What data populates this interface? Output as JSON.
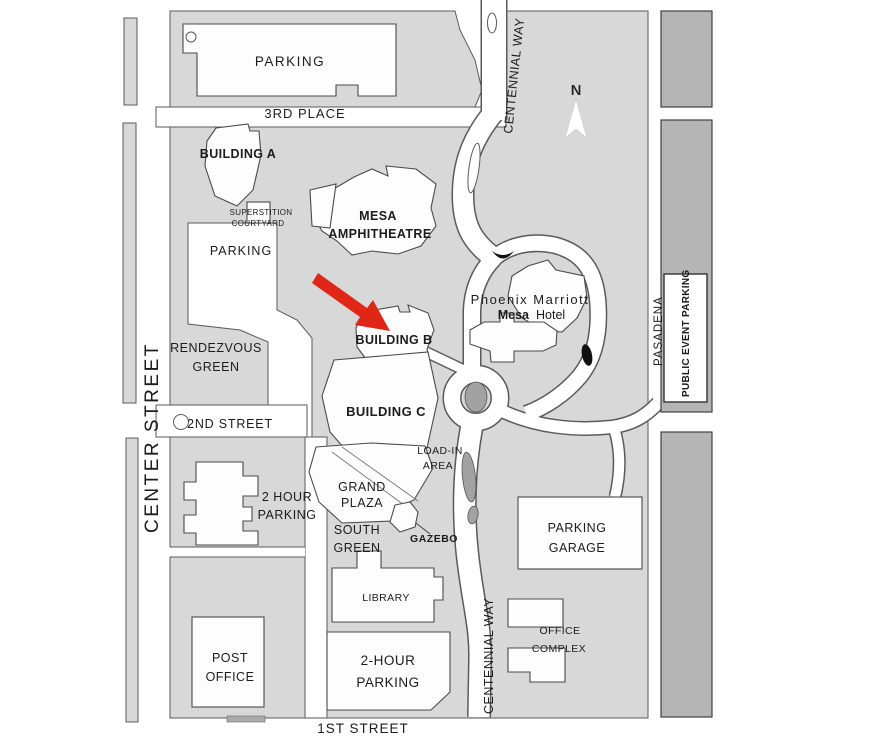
{
  "map": {
    "streets": {
      "third_place": "3RD PLACE",
      "second_street": "2ND STREET",
      "first_street": "1ST STREET",
      "center_street": "CENTER STREET",
      "centennial_way_top": "CENTENNIAL WAY",
      "centennial_way_bottom": "CENTENNIAL WAY",
      "pasadena": "PASADENA"
    },
    "labels": {
      "parking_lot_top": "PARKING",
      "building_a": "BUILDING A",
      "superstition_1": "SUPERSTITION",
      "superstition_2": "COURTYARD",
      "parking_a": "PARKING",
      "amphitheatre_1": "MESA",
      "amphitheatre_2": "AMPHITHEATRE",
      "hotel_1": "Phoenix Marriott",
      "hotel_2a": "Mesa",
      "hotel_2b": "Hotel",
      "building_b": "BUILDING B",
      "rendezvous_1": "RENDEZVOUS",
      "rendezvous_2": "GREEN",
      "building_c": "BUILDING C",
      "load_in_1": "LOAD-IN",
      "load_in_2": "AREA",
      "two_hour_west_1": "2 HOUR",
      "two_hour_west_2": "PARKING",
      "grand_1": "GRAND",
      "grand_2": "PLAZA",
      "south_1": "SOUTH",
      "south_2": "GREEN",
      "gazebo": "GAZEBO",
      "garage_1": "PARKING",
      "garage_2": "GARAGE",
      "library": "LIBRARY",
      "post_1": "POST",
      "post_2": "OFFICE",
      "two_hour_south_1": "2-HOUR",
      "two_hour_south_2": "PARKING",
      "office_1": "OFFICE",
      "office_2": "COMPLEX",
      "public_event_parking": "PUBLIC EVENT PARKING",
      "compass_n": "N"
    },
    "colors": {
      "block_gray": "#d8d8d8",
      "dark_block_gray": "#b5b5b5",
      "road_white": "#ffffff",
      "outline": "#5a5a5a",
      "text": "#1c1c1c",
      "arrow_red": "#e02717"
    }
  }
}
